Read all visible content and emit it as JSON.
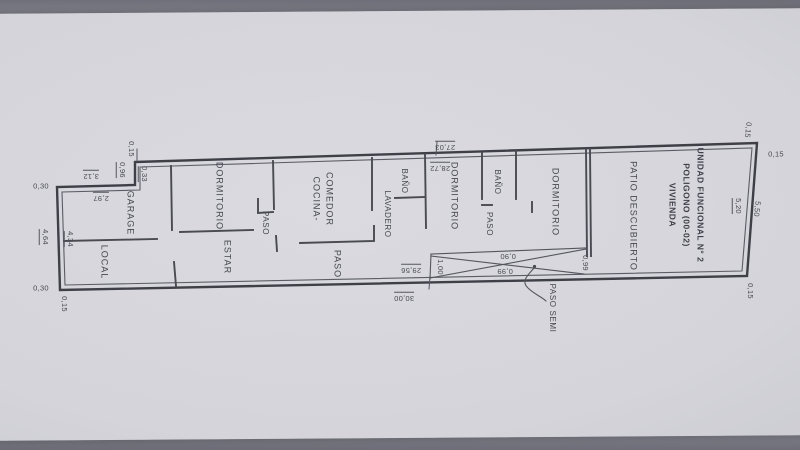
{
  "title_block": {
    "line1": "UNIDAD FUNCIONAL N° 2",
    "line2": "POLIGONO (00-02)",
    "line3": "VIVIENDA"
  },
  "rooms": {
    "garage": "GARAGE",
    "local": "LOCAL",
    "dormitorio_1": "DORMITORIO",
    "estar": "ESTAR",
    "paso_nook": "PASO",
    "cocina_l1": "COCINA-",
    "cocina_l2": "COMEDOR",
    "paso_corridor": "PASO",
    "lavadero": "LAVADERO",
    "bano_1": "BAÑO",
    "dormitorio_2": "DORMITORIO",
    "bano_2": "BAÑO",
    "paso_3": "PASO",
    "dormitorio_3": "DORMITORIO",
    "patio": "PATIO DESCUBIERTO",
    "paso_semi": "PASO SEMI"
  },
  "dims": {
    "step_offset": "0,15",
    "step_096": "0,96",
    "step_033": "0,33",
    "garage_outer": "3,12",
    "garage_inner": "2,97",
    "left_wall_top": "0,30",
    "left_outer": "4,64",
    "left_inner": "4,34",
    "left_wall_bottom": "0,30",
    "bottom_left_offset": "0,15",
    "top_2703": "27,03",
    "top_2872": "28,72",
    "bottom_2956": "29,56",
    "bottom_3000": "30,00",
    "strip_100": "1,00",
    "strip_090": "0,90",
    "strip_099a": "0,99",
    "strip_099b": "0,99",
    "top_right_a": "0,15",
    "top_right_b": "0,15",
    "right_inner": "5,20",
    "right_outer": "5,50",
    "bottom_right_offset": "0,15"
  }
}
